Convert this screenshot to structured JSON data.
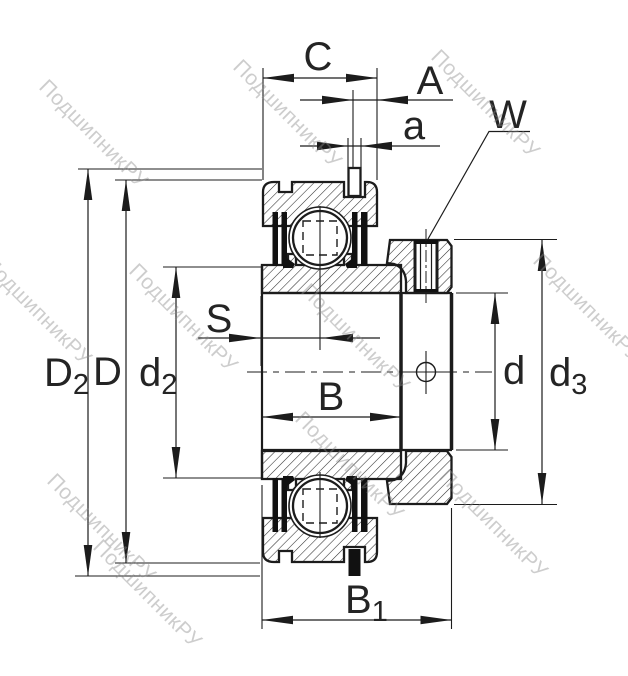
{
  "drawing": {
    "kind": "bearing-cross-section"
  },
  "labels": {
    "C": "C",
    "A": "A",
    "a": "a",
    "W": "W",
    "S": "S",
    "B": "B",
    "B1": {
      "main": "B",
      "sub": "1"
    },
    "D2": {
      "main": "D",
      "sub": "2"
    },
    "D": "D",
    "d2": {
      "main": "d",
      "sub": "2"
    },
    "d": "d",
    "d3": {
      "main": "d",
      "sub": "3"
    }
  },
  "watermark": {
    "text": "ПодшипникРУ",
    "color": "#c9c9c9"
  },
  "colors": {
    "line": "#1c1c1c",
    "hatch": "#2e2e2e",
    "background": "#ffffff"
  }
}
